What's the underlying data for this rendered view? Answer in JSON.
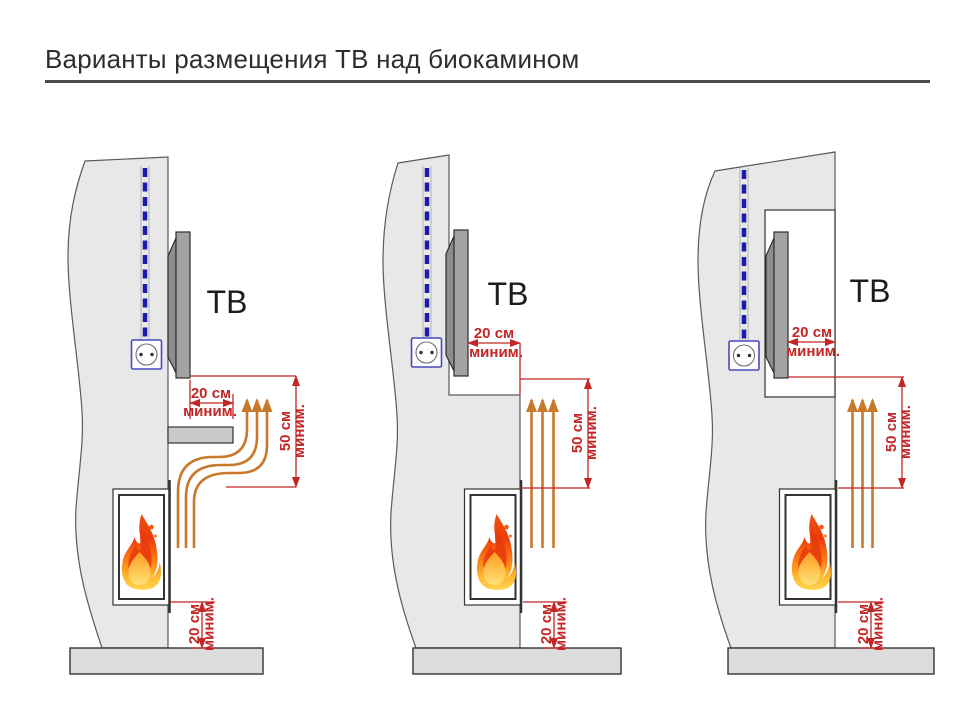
{
  "title": "Варианты размещения ТВ над биокамином",
  "labels": {
    "tv": "ТВ",
    "cm20": "20 см",
    "cm50": "50 см",
    "minimum": "миним."
  },
  "colors": {
    "dimension": "#c22626",
    "heat_arrow": "#c8792c",
    "cable": "#1b1bb0",
    "wall": "#e8e8e8",
    "floor": "#dcdcdc",
    "flame_core": "#e83a0d",
    "flame_glow": "#ffd954"
  },
  "panels": [
    {
      "tv": "ТВ",
      "top_gap": {
        "value": "20 см",
        "note": "миним."
      },
      "vertical_clearance": {
        "value": "50 см",
        "note": "миним."
      },
      "floor_clearance": {
        "value": "20 см",
        "note": "миним."
      }
    },
    {
      "tv": "ТВ",
      "top_gap": {
        "value": "20 см",
        "note": "миним."
      },
      "vertical_clearance": {
        "value": "50 см",
        "note": "миним."
      },
      "floor_clearance": {
        "value": "20 см",
        "note": "миним."
      }
    },
    {
      "tv": "ТВ",
      "top_gap": {
        "value": "20 см",
        "note": "миним."
      },
      "vertical_clearance": {
        "value": "50 см",
        "note": "миним."
      },
      "floor_clearance": {
        "value": "20 см",
        "note": "миним."
      }
    }
  ]
}
